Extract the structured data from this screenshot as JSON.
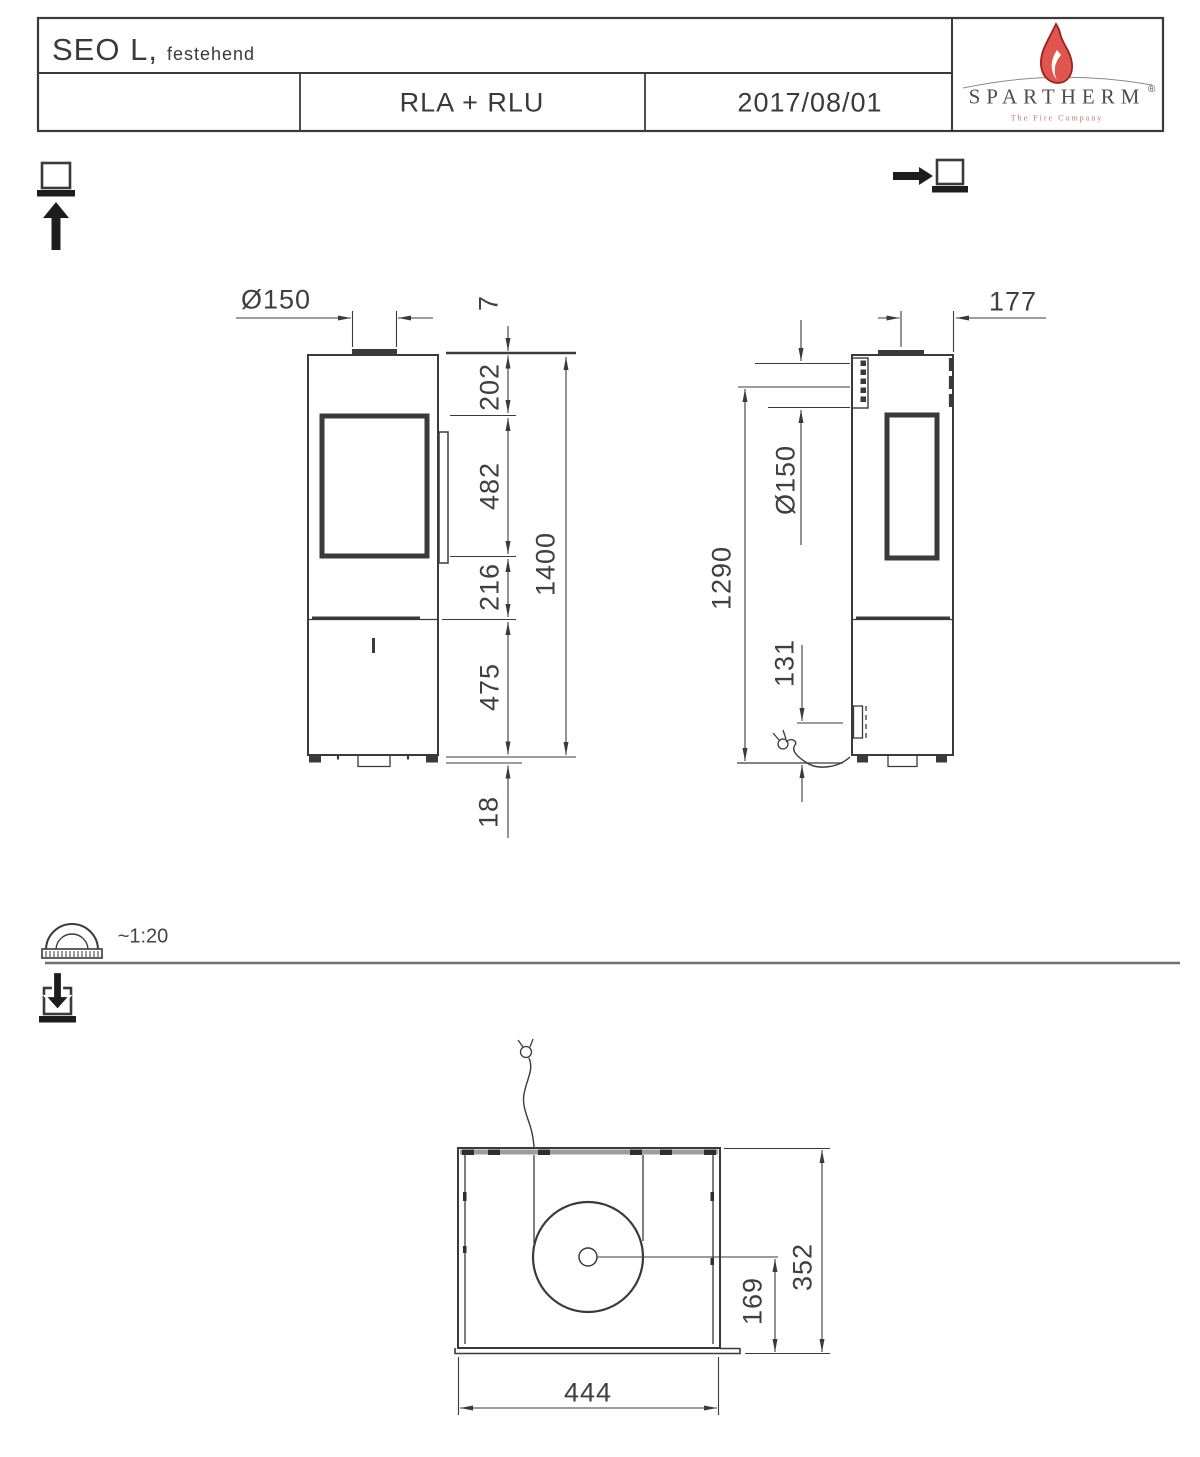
{
  "header": {
    "product": "SEO L,",
    "product_variant_note": "festehend",
    "air_system": "RLA + RLU",
    "date": "2017/08/01",
    "brand": {
      "name": "SPARTHERM",
      "registered_mark": "®",
      "tagline": "The Fire Company"
    }
  },
  "scale_note": {
    "label": "~1:20"
  },
  "view_markers": {
    "front": "view-arrow-up-at-panel",
    "side": "view-arrow-right-at-panel",
    "top": "view-arrow-down-into-panel",
    "scale_icon": "protractor"
  },
  "front_view": {
    "dims": {
      "flue_diameter": "Ø150",
      "collar": "7",
      "top_to_window": "202",
      "window_height": "482",
      "window_to_joint": "216",
      "base_height": "475",
      "floor_gap": "18",
      "total_height": "1400"
    }
  },
  "side_view": {
    "dims": {
      "flue_center_to_front": "177",
      "rear_air_diameter": "Ø150",
      "rear_air_center_height": "1290",
      "cable_height": "131"
    }
  },
  "top_view": {
    "dims": {
      "width": "444",
      "depth": "352",
      "flue_offset": "169"
    }
  },
  "colors": {
    "line": "#3a3a3a",
    "flame": "#e0564e",
    "flame_outline": "#9b221e",
    "tagline_red": "#c9736d"
  }
}
